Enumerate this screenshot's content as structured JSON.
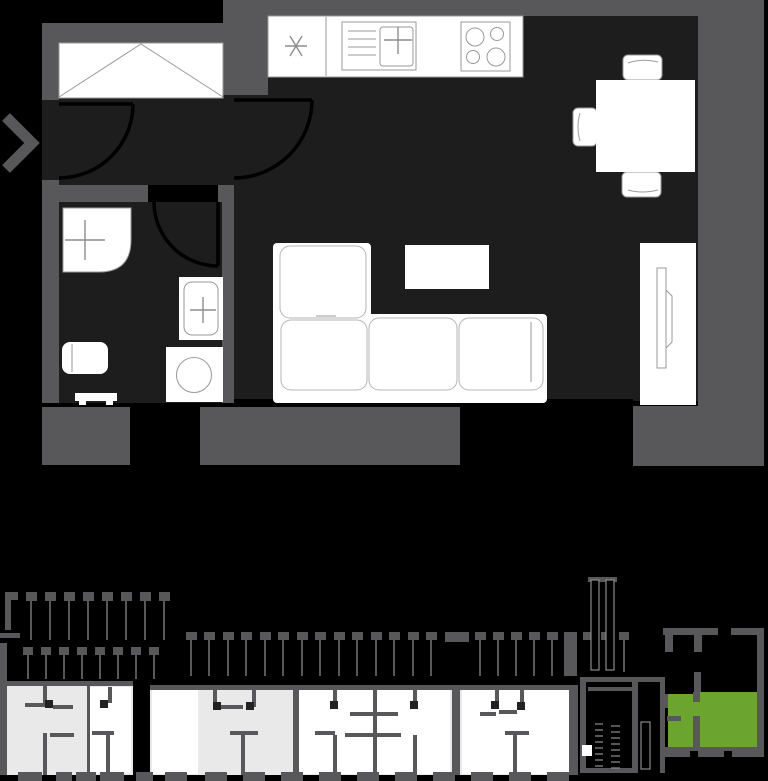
{
  "colors": {
    "background": "#000000",
    "wall": "#58585a",
    "floor": "#1d1d1d",
    "fixture_fill": "#ffffff",
    "fixture_line": "#9a9a9a",
    "door_line": "#000000",
    "overview_floor": "#e9e9e9",
    "overview_room": "#ffffff",
    "overview_wall": "#58585a",
    "door_marker": "#222222",
    "highlight_green": "#6ba42f"
  },
  "detail_plan": {
    "type": "apartment-floor-plan",
    "entrance_marker": "chevron-right-icon",
    "rooms": [
      "hallway",
      "bathroom",
      "living-room-with-open-kitchen"
    ],
    "furniture": [
      "wardrobe-with-diagonals",
      "kitchen-counter",
      "freezer-asterisk-symbol",
      "kitchen-sink-with-drainer",
      "stove-four-burners",
      "dining-table",
      "chair-top",
      "chair-left",
      "chair-bottom",
      "corner-sofa",
      "coffee-table",
      "tv-sideboard-with-tv",
      "shower-tray",
      "washbasin",
      "toilet",
      "washing-machine",
      "radiator"
    ],
    "doors": [
      "entrance-door",
      "hall-to-living-room-door",
      "bathroom-door"
    ]
  },
  "overview_plan": {
    "type": "building-floor-overview",
    "features": [
      "balcony-railings",
      "neighbor-apartments",
      "stairwell-core",
      "facade-piers"
    ],
    "highlighted_unit": {
      "name": "selected-apartment",
      "color": "#6ba42f",
      "position": "bottom-right"
    }
  }
}
